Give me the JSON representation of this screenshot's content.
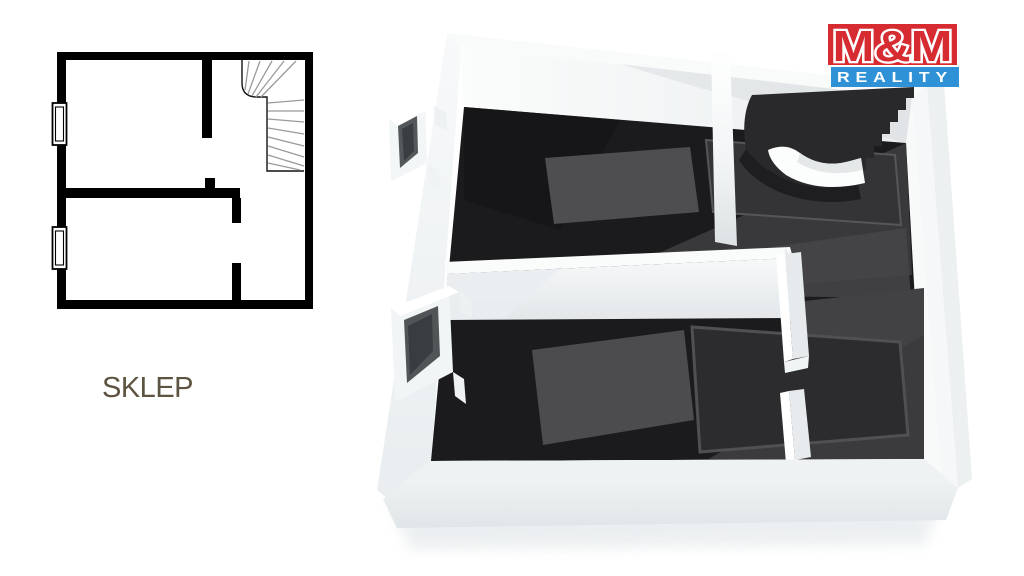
{
  "page": {
    "background": "#ffffff"
  },
  "plan_2d": {
    "room_label": "SKLEP",
    "room_label_color": "#5c5340",
    "wall_color": "#000000",
    "stair_tread_color": "#9a9a9a",
    "features": [
      "outer-walls",
      "interior-partition-walls",
      "winder-staircase-top-right",
      "two-window-symbols-left-wall",
      "door-openings"
    ]
  },
  "plan_3d": {
    "wall_color": "#f4f7f8",
    "floor_color": "#1b1b1d",
    "reflection_color": "#4c4c4e",
    "staircase_color": "#29292b",
    "railing_color": "#fcfdfd"
  },
  "logo": {
    "line1": "M&M",
    "line2": "REALITY",
    "red": "#d52b31",
    "blue": "#2f92d6",
    "text_color": "#ffffff"
  }
}
